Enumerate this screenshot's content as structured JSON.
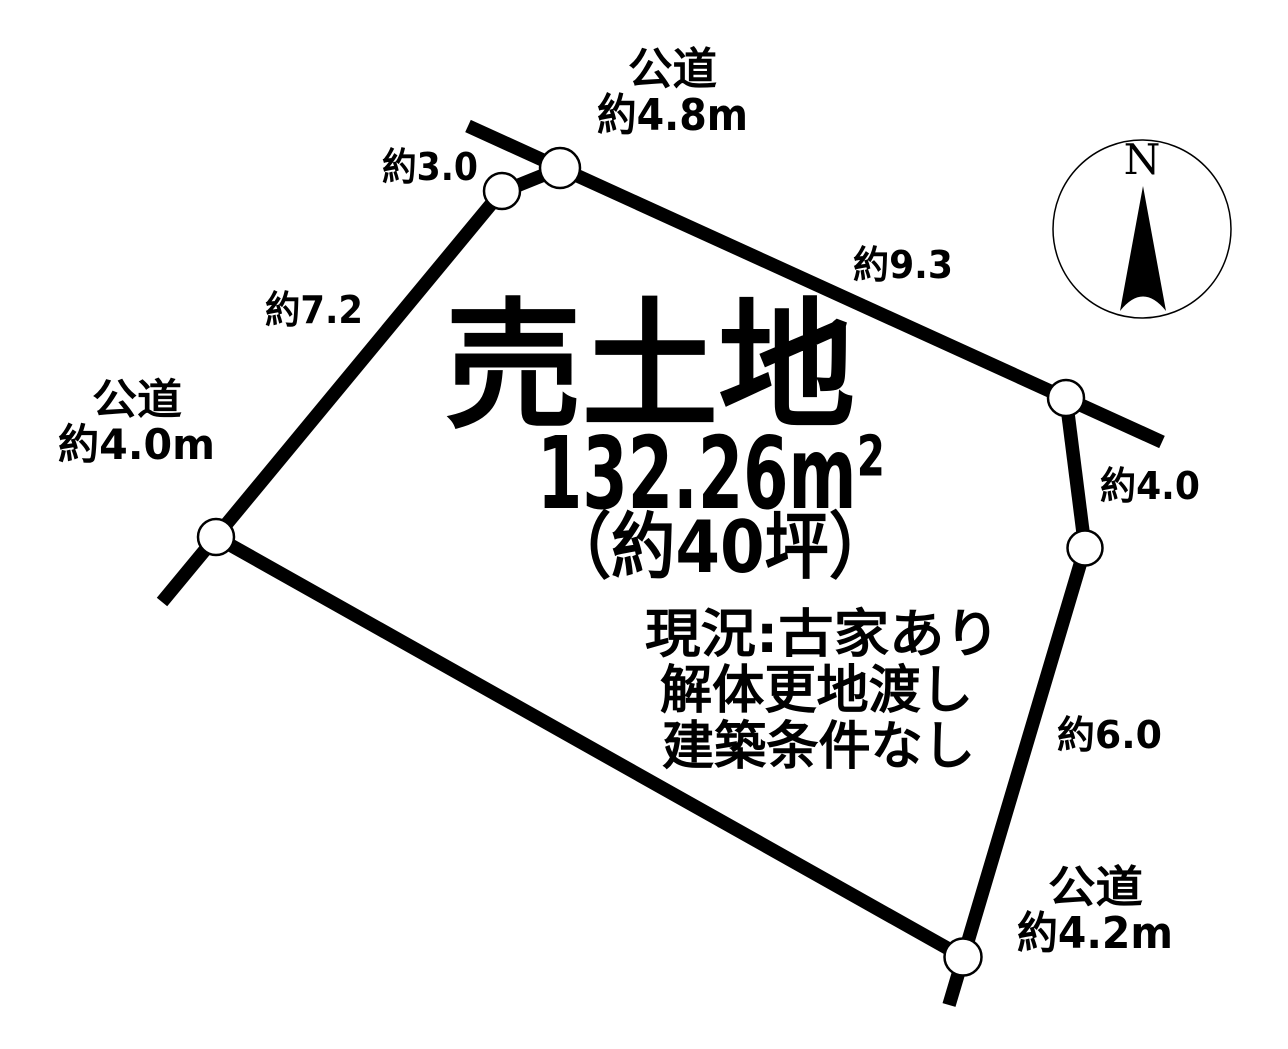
{
  "diagram": {
    "title": "売土地",
    "area": "132.26m²",
    "area_tsubo": "（約40坪）",
    "notes": [
      "現況:古家あり",
      "解体更地渡し",
      "建築条件なし"
    ]
  },
  "roads": {
    "top": {
      "type": "公道",
      "width": "約4.8m"
    },
    "left": {
      "type": "公道",
      "width": "約4.0m"
    },
    "bottom_right": {
      "type": "公道",
      "width": "約4.2m"
    }
  },
  "edges": {
    "north_short": "約3.0",
    "northeast": "約9.3",
    "west": "約7.2",
    "east_upper": "約4.0",
    "east_lower": "約6.0"
  },
  "compass": {
    "north_label": "N"
  },
  "colors": {
    "line": "#000000",
    "background": "#ffffff",
    "text": "#000000"
  }
}
